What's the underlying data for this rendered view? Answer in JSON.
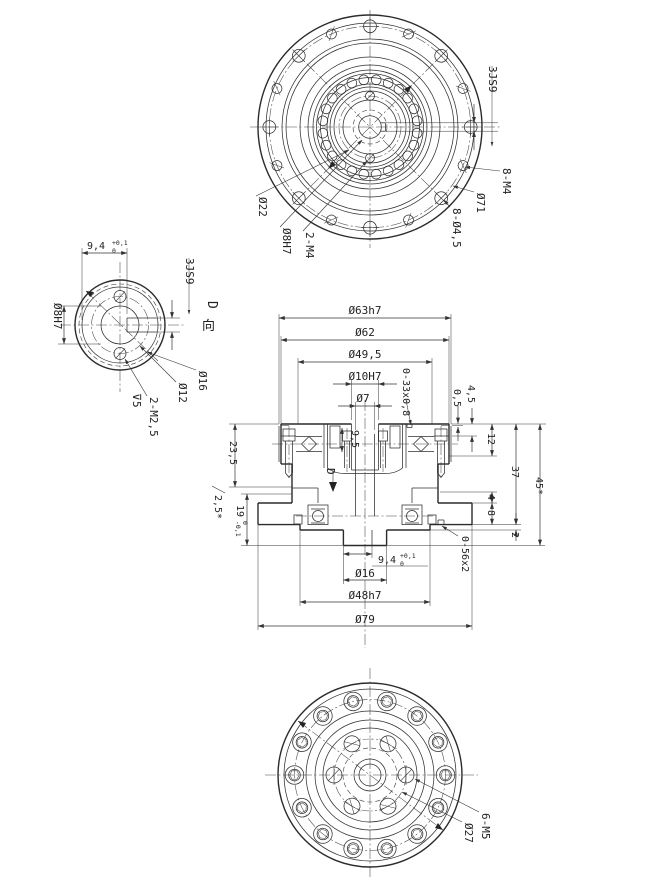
{
  "drawing": {
    "background": "#ffffff",
    "line_color": "#2b2b2b",
    "top_view": {
      "labels": {
        "keyway_width": "3JS9",
        "thread_holes": "8-M4",
        "bolt_circle": "Ø71",
        "through_holes": "8-Ø4,5",
        "hub_bolt_circle": "Ø22",
        "center_bore": "Ø8H7",
        "hub_screws": "2-M4"
      }
    },
    "d_view": {
      "title_letter": "D",
      "title_char": "向",
      "labels": {
        "keyway_depth": "9,4",
        "keyway_depth_tol_up": "+0,1",
        "keyway_depth_tol_low": "0",
        "keyway_width": "3JS9",
        "center_bore": "Ø8H7",
        "shaft": "Ø16",
        "screw_circle": "Ø12",
        "screws": "2-M2,5",
        "screw_depth": "⊽5"
      }
    },
    "section_view": {
      "view_arrow": "D",
      "top_dims": {
        "d63": "Ø63h7",
        "d62": "Ø62",
        "d49": "Ø49,5",
        "d10": "Ø10H7",
        "d7": "Ø7"
      },
      "oring_top": "0-33x0,8",
      "oring_bottom": "0-56x2",
      "inner_depth": "9,5",
      "step_small": "0,5",
      "step_big": "4,5",
      "right_dims": {
        "bearing_h": "12",
        "body_h": "37",
        "total_h": "45*",
        "step4": "4",
        "flange_t": "8",
        "boss_t": "2"
      },
      "left_dims": {
        "upper": "23,5",
        "gap": "2,5*",
        "lower": "19",
        "lower_tol_up": "0",
        "lower_tol_low": "-0,1"
      },
      "bottom_dims": {
        "keyway_depth": "9,4",
        "keyway_tol_up": "+0,1",
        "keyway_tol_low": "0",
        "shaft": "Ø16",
        "boss": "Ø48h7",
        "flange": "Ø79"
      }
    },
    "bottom_view": {
      "labels": {
        "thread_holes": "6-M5",
        "bolt_circle": "Ø27"
      }
    }
  }
}
